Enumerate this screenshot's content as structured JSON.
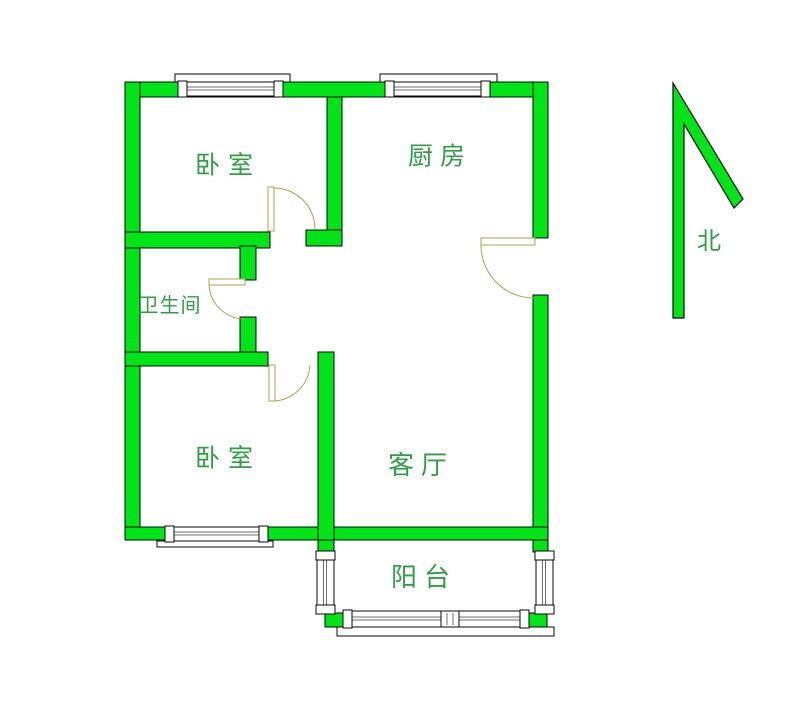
{
  "page": {
    "width": 800,
    "height": 704,
    "background": "#ffffff"
  },
  "colors": {
    "wall": "#00e418",
    "outline": "#0a0a0a",
    "door": "#b2a04e",
    "label": "#2f9e44",
    "window_line": "#6f6f6f",
    "window_fill": "#ffffff"
  },
  "rooms": [
    {
      "id": "bedroom-1",
      "label": "卧室",
      "cx": 228,
      "cy": 165,
      "fs": 25,
      "ls": 8
    },
    {
      "id": "kitchen",
      "label": "厨房",
      "cx": 440,
      "cy": 156,
      "fs": 25,
      "ls": 7
    },
    {
      "id": "bathroom",
      "label": "卫生间",
      "cx": 170,
      "cy": 305,
      "fs": 20,
      "ls": 1
    },
    {
      "id": "bedroom-2",
      "label": "卧室",
      "cx": 228,
      "cy": 458,
      "fs": 25,
      "ls": 8
    },
    {
      "id": "living-room",
      "label": "客厅",
      "cx": 421,
      "cy": 466,
      "fs": 26,
      "ls": 7
    },
    {
      "id": "balcony",
      "label": "阳台",
      "cx": 424,
      "cy": 578,
      "fs": 26,
      "ls": 7
    }
  ],
  "compass": {
    "label": "北",
    "cx": 709,
    "cy": 241,
    "fs": 24,
    "arrow_points": "673,83 743,199 734,208 684,124 684,318 673,318"
  },
  "walls": [
    {
      "id": "wall-top",
      "x": 125,
      "y": 82,
      "w": 423,
      "h": 15
    },
    {
      "id": "wall-left",
      "x": 125,
      "y": 82,
      "w": 15,
      "h": 458
    },
    {
      "id": "wall-right-upper",
      "x": 533,
      "y": 82,
      "w": 15,
      "h": 156
    },
    {
      "id": "wall-right-lower",
      "x": 533,
      "y": 295,
      "w": 15,
      "h": 245
    },
    {
      "id": "wall-bottom",
      "x": 125,
      "y": 527,
      "w": 423,
      "h": 13
    },
    {
      "id": "wall-kitchen-left",
      "x": 327,
      "y": 97,
      "w": 15,
      "h": 135
    },
    {
      "id": "wall-entry-corner",
      "x": 306,
      "y": 230,
      "w": 36,
      "h": 16
    },
    {
      "id": "wall-bath-top",
      "x": 125,
      "y": 232,
      "w": 145,
      "h": 16
    },
    {
      "id": "wall-bath-right-up",
      "x": 240,
      "y": 246,
      "w": 16,
      "h": 34
    },
    {
      "id": "wall-bath-right-low",
      "x": 240,
      "y": 317,
      "w": 16,
      "h": 37
    },
    {
      "id": "wall-bath-bottom",
      "x": 125,
      "y": 352,
      "w": 143,
      "h": 14
    },
    {
      "id": "wall-bedroom2-right",
      "x": 318,
      "y": 352,
      "w": 16,
      "h": 188
    },
    {
      "id": "wall-balcony-stub-l",
      "x": 318,
      "y": 540,
      "w": 16,
      "h": 12
    },
    {
      "id": "wall-balcony-stub-r",
      "x": 533,
      "y": 540,
      "w": 15,
      "h": 12
    },
    {
      "id": "wall-balcony-corner-l",
      "x": 325,
      "y": 613,
      "w": 18,
      "h": 14
    },
    {
      "id": "wall-balcony-corner-r",
      "x": 529,
      "y": 613,
      "w": 18,
      "h": 14
    }
  ],
  "sills": [
    {
      "id": "sill-bedroom1-window",
      "x": 175,
      "y": 74,
      "w": 115,
      "h": 8
    },
    {
      "id": "sill-kitchen-window",
      "x": 380,
      "y": 74,
      "w": 117,
      "h": 8
    },
    {
      "id": "sill-bedroom2-window",
      "x": 157,
      "y": 541,
      "w": 116,
      "h": 6
    },
    {
      "id": "sill-balcony-window",
      "x": 337,
      "y": 627,
      "w": 217,
      "h": 9
    }
  ],
  "windows": [
    {
      "id": "window-bedroom1-top",
      "dir": "h",
      "x": 178,
      "y": 82,
      "w": 105,
      "h": 14
    },
    {
      "id": "window-kitchen-top",
      "dir": "h",
      "x": 385,
      "y": 82,
      "w": 105,
      "h": 14
    },
    {
      "id": "window-bedroom2-bottom",
      "dir": "h",
      "x": 165,
      "y": 527,
      "w": 103,
      "h": 14
    },
    {
      "id": "window-balcony-left",
      "dir": "v",
      "x": 317,
      "y": 551,
      "w": 17,
      "h": 63
    },
    {
      "id": "window-balcony-right",
      "dir": "v",
      "x": 536,
      "y": 551,
      "w": 17,
      "h": 63
    },
    {
      "id": "window-balcony-bottom",
      "dir": "h",
      "x": 343,
      "y": 611,
      "w": 186,
      "h": 16,
      "mullion": {
        "x": 441,
        "w": 18
      }
    }
  ],
  "doors": [
    {
      "id": "door-bedroom-1",
      "leaf": {
        "x": 268,
        "y": 187,
        "w": 6,
        "h": 44
      },
      "arc": "M 274,188 A 41,41 0 0 1 315,229"
    },
    {
      "id": "door-bathroom",
      "leaf": {
        "x": 209,
        "y": 279,
        "w": 36,
        "h": 6
      },
      "arc": "M 209,284 A 36,36 0 0 0 245,319"
    },
    {
      "id": "door-bedroom-2",
      "leaf": {
        "x": 269,
        "y": 365,
        "w": 6,
        "h": 36
      },
      "arc": "M 272,401 A 38,38 0 0 0 310,365"
    },
    {
      "id": "door-entry-kitchen",
      "leaf": {
        "x": 481,
        "y": 238,
        "w": 54,
        "h": 7
      },
      "arc": "M 481,245 A 53,53 0 0 0 534,298"
    }
  ]
}
